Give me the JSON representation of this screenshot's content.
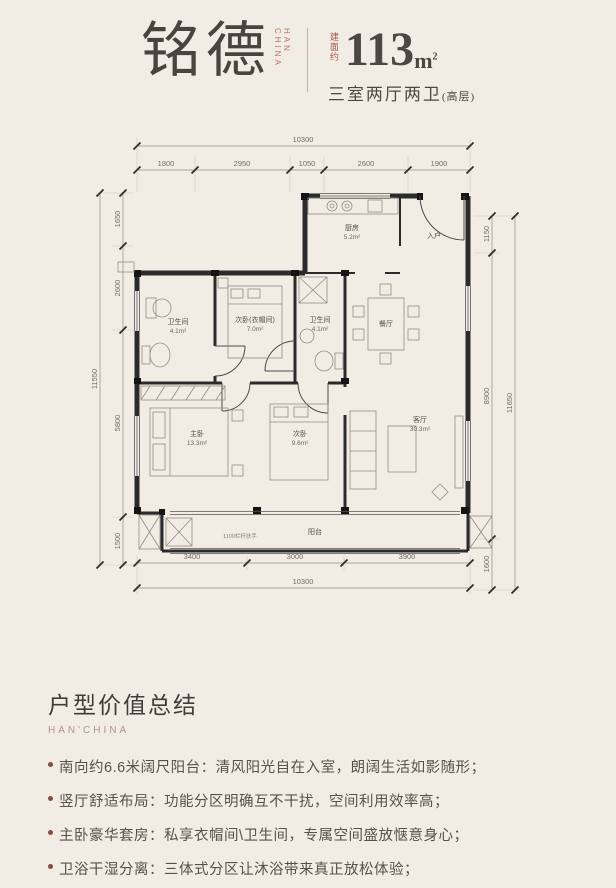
{
  "header": {
    "brand": "铭德",
    "brand_en_line1": "HAN",
    "brand_en_line2": "CHINA",
    "area_prefix": "建面约",
    "area_value": "113",
    "area_unit": "m",
    "area_sup": "2",
    "subtitle": "三室两厅两卫",
    "subtitle_note": "(高层)"
  },
  "plan": {
    "dims": {
      "top_total": "10300",
      "top_segments": [
        "1800",
        "2950",
        "1050",
        "2600",
        "1900"
      ],
      "left_total": "11550",
      "left_segments": [
        "1650",
        "2600",
        "5800",
        "1500"
      ],
      "right_total": "11650",
      "right_segments": [
        "1150",
        "8900",
        "1600"
      ],
      "bottom_segments": [
        "3400",
        "3000",
        "3900"
      ],
      "bottom_total": "10300"
    },
    "rooms": {
      "bath1": {
        "name": "卫生间",
        "area": "4.1m²"
      },
      "cloak": {
        "name": "次卧(衣帽间)",
        "area": "7.0m²"
      },
      "bath2": {
        "name": "卫生间",
        "area": "4.1m²"
      },
      "kitchen": {
        "name": "厨房",
        "area": "5.2m²"
      },
      "entry": {
        "name": "入户"
      },
      "dining": {
        "name": "餐厅"
      },
      "master": {
        "name": "主卧",
        "area": "13.3m²"
      },
      "bed2": {
        "name": "次卧",
        "area": "9.6m²"
      },
      "living": {
        "name": "客厅",
        "area": "30.3m²"
      },
      "balcony": {
        "name": "阳台"
      }
    },
    "balcony_note": "1100栏杆扶手"
  },
  "summary": {
    "title": "户型价值总结",
    "subtitle": "HAN'CHINA",
    "bullets": [
      "南向约6.6米阔尺阳台：清风阳光自在入室，朗阔生活如影随形；",
      "竖厅舒适布局：功能分区明确互不干扰，空间利用效率高；",
      "主卧豪华套房：私享衣帽间\\卫生间，专属空间盛放惬意身心；",
      "卫浴干湿分离：三体式分区让沐浴带来真正放松体验；"
    ]
  },
  "colors": {
    "background": "#f2ede4",
    "accent_red": "#a8544d",
    "muted_red": "#b2928f",
    "ink": "#47453f",
    "wall": "#2b2b2b"
  }
}
